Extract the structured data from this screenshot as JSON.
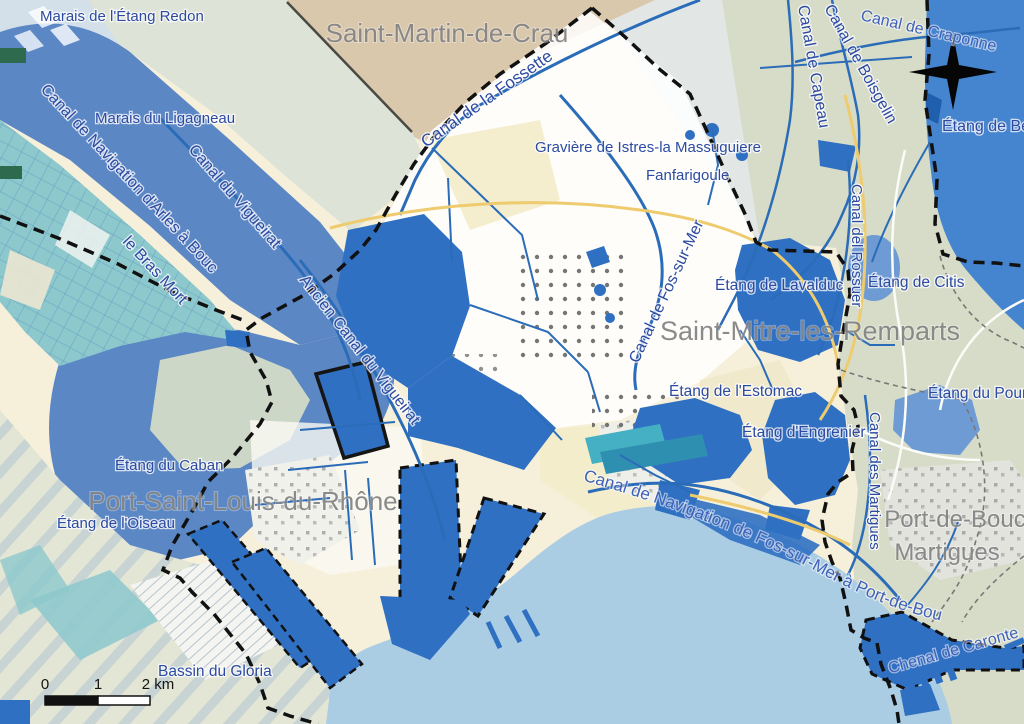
{
  "map_title": "Carte des canaux et étangs de la zone de Fos-sur-Mer",
  "labels": {
    "marais_etang_redon": "Marais de l'Étang Redon",
    "saint_martin_de_crau": "Saint-Martin-de-Crau",
    "marais_du_ligagneau": "Marais du Ligagneau",
    "canal_navigation_arles_bouc": "Canal de Navigation d'Arles à Bouc",
    "canal_du_vigueirat": "Canal du Vigueirat",
    "le_bras_mort": "le Bras Mort",
    "canal_de_la_fossette": "Canal de la Fossette",
    "graviere_istres": "Gravière de Istres-la Massuguiere",
    "fanfarigoule": "Fanfarigoule",
    "canal_de_capeau": "Canal de Capeau",
    "canal_de_boisgelin": "Canal de Boisgelin",
    "canal_de_craponne": "Canal de Craponne",
    "etang_de_berre": "Étang de Berre",
    "canal_del_rossuer": "Canal del Rossuer",
    "etang_de_lavalduc": "Étang de Lavalduc",
    "etang_de_citis": "Étang de Citis",
    "canal_de_fos_sur_mer": "Canal de Fos-sur-Mer",
    "saint_mitre_les_remparts": "Saint-Mitre-les-Remparts",
    "etang_de_l_estomac": "Étang de l'Estomac",
    "etang_d_engrenier": "Étang d'Engrenier",
    "etang_du_pourra": "Étang du Pourra",
    "canal_des_martigues": "Canal des Martigues",
    "ancien_canal_du_vigueirat": "Ancien Canal du Vigueirat",
    "etang_du_caban": "Étang du Caban",
    "port_saint_louis_du_rhone": "Port-Saint-Louis-du-Rhône",
    "etang_de_l_oiseau": "Étang de l'Oiseau",
    "bassin_du_gloria": "Bassin du Gloria",
    "canal_navigation_fos_port_de_bouc": "Canal de Navigation de Fos-sur-Mer à Port-de-Bouc",
    "port_de_bouc": "Port-de-Bouc",
    "martigues": "Martigues",
    "chenal_de_caronte": "Chenal de Caronte"
  },
  "scale_bar": {
    "tick_0": "0",
    "tick_1": "1",
    "tick_2": "2 km"
  },
  "colors": {
    "water_dark": "#2f70c2",
    "sea": "#abcde4",
    "etang_berre": "#4584cf",
    "etang_light": "#6f9bd4",
    "canal_band_blue": "#5b87c5",
    "teal_marsh": "#8cc8cc",
    "dock_teal": "#45b0c4",
    "terrain_green": "#d7dcc9",
    "crau_tan": "#d9c8ac",
    "plain_cream": "#f6f0da",
    "label_blue": "#2c4aa0",
    "label_gray": "#858585",
    "boundary_black": "#111111",
    "canal_line_blue": "#2b6cb8",
    "road_yellow": "#eecb6e"
  }
}
